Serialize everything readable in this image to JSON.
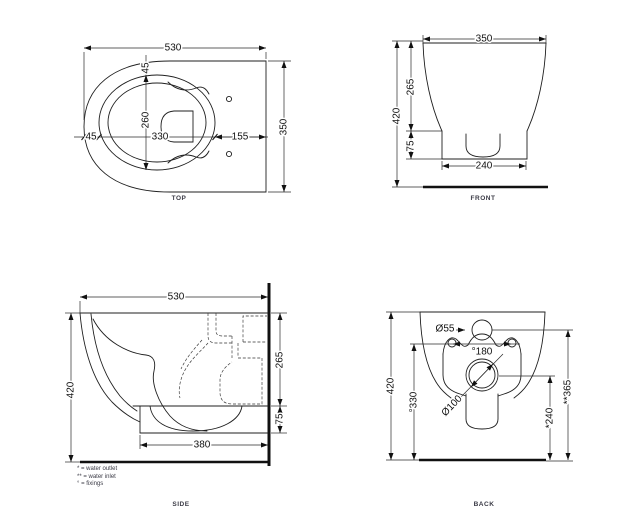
{
  "drawing": {
    "colors": {
      "line": "#1f1f1f",
      "background": "#ffffff",
      "label": "#3b3b46"
    },
    "views": {
      "top": {
        "label": "TOP",
        "dims": {
          "overall_length": "530",
          "seat_inset": "45",
          "bowl_width": "260",
          "nose_offset": "45",
          "seat_length": "330",
          "rear_offset": "155",
          "overall_width": "350"
        }
      },
      "front": {
        "label": "FRONT",
        "dims": {
          "overall_width": "350",
          "overall_height": "420",
          "bowl_height": "265",
          "skirt_height": "75",
          "base_width": "240"
        }
      },
      "side": {
        "label": "SIDE",
        "dims": {
          "overall_depth": "530",
          "overall_height": "420",
          "bowl_height": "265",
          "skirt_height": "75",
          "base_depth": "380"
        }
      },
      "back": {
        "label": "BACK",
        "dims": {
          "overall_height": "420",
          "inlet_diameter": "Ø55",
          "fixing_spacing": "°180",
          "fixing_height": "°330",
          "outlet_diameter": "Ø100",
          "outlet_height": "*240",
          "inlet_height": "**365"
        }
      }
    },
    "legend": {
      "water_outlet": "* = water outlet",
      "water_inlet": "** = water inlet",
      "fixings": "° = fixings"
    }
  }
}
